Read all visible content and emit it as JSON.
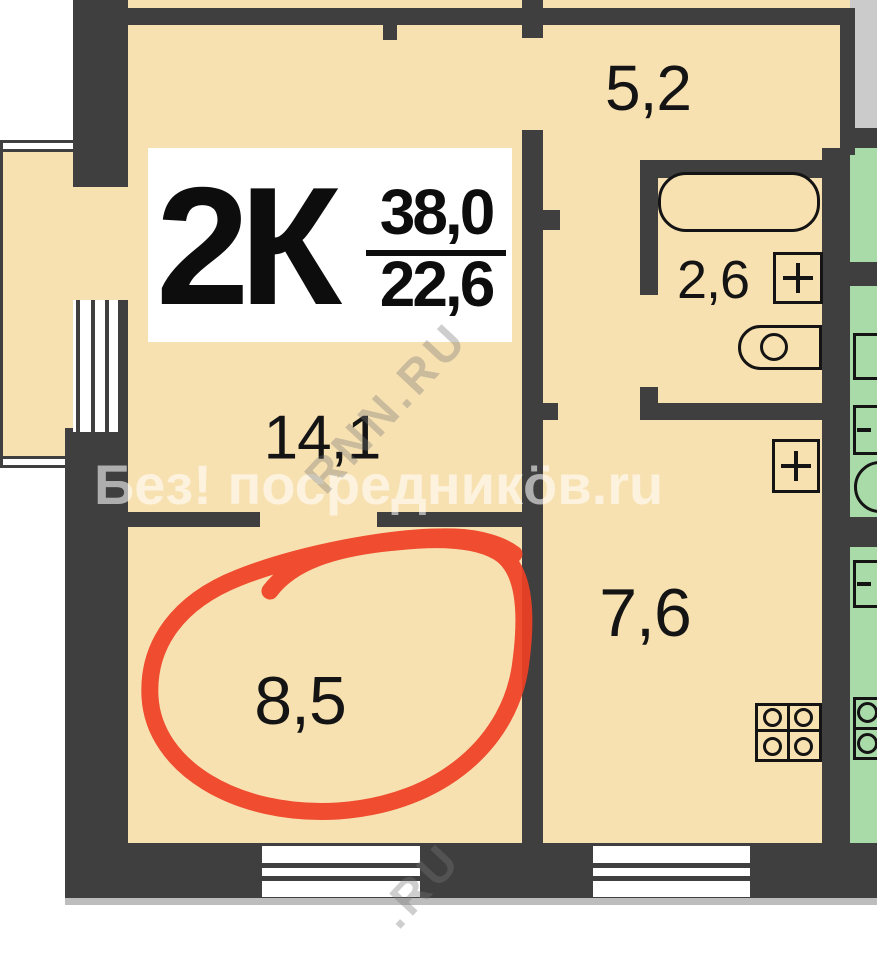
{
  "plan": {
    "type_label": "2К",
    "area_total": "38,0",
    "area_living": "22,6",
    "rooms": [
      {
        "id": "hallway",
        "area": "5,2"
      },
      {
        "id": "bathroom",
        "area": "2,6"
      },
      {
        "id": "living-room",
        "area": "14,1"
      },
      {
        "id": "room-highlighted",
        "area": "8,5"
      },
      {
        "id": "kitchen",
        "area": "7,6"
      }
    ]
  },
  "watermarks": {
    "main": "Без! посредникöв.ru",
    "diagonal_upper": "RNN.RU",
    "diagonal_lower": ".RU"
  },
  "icons": {
    "sink_plus": "plus-cross",
    "bathtub": "bathtub-outline",
    "toilet": "toilet-outline",
    "stove": "four-burner-stove"
  },
  "colors": {
    "floor": "#f8e1b1",
    "wall": "#3f3f3f",
    "neighbor_unit": "#a9dba9",
    "stairwell": "#cbcbcb",
    "marker": "#ee4126",
    "background": "#ffffff"
  }
}
